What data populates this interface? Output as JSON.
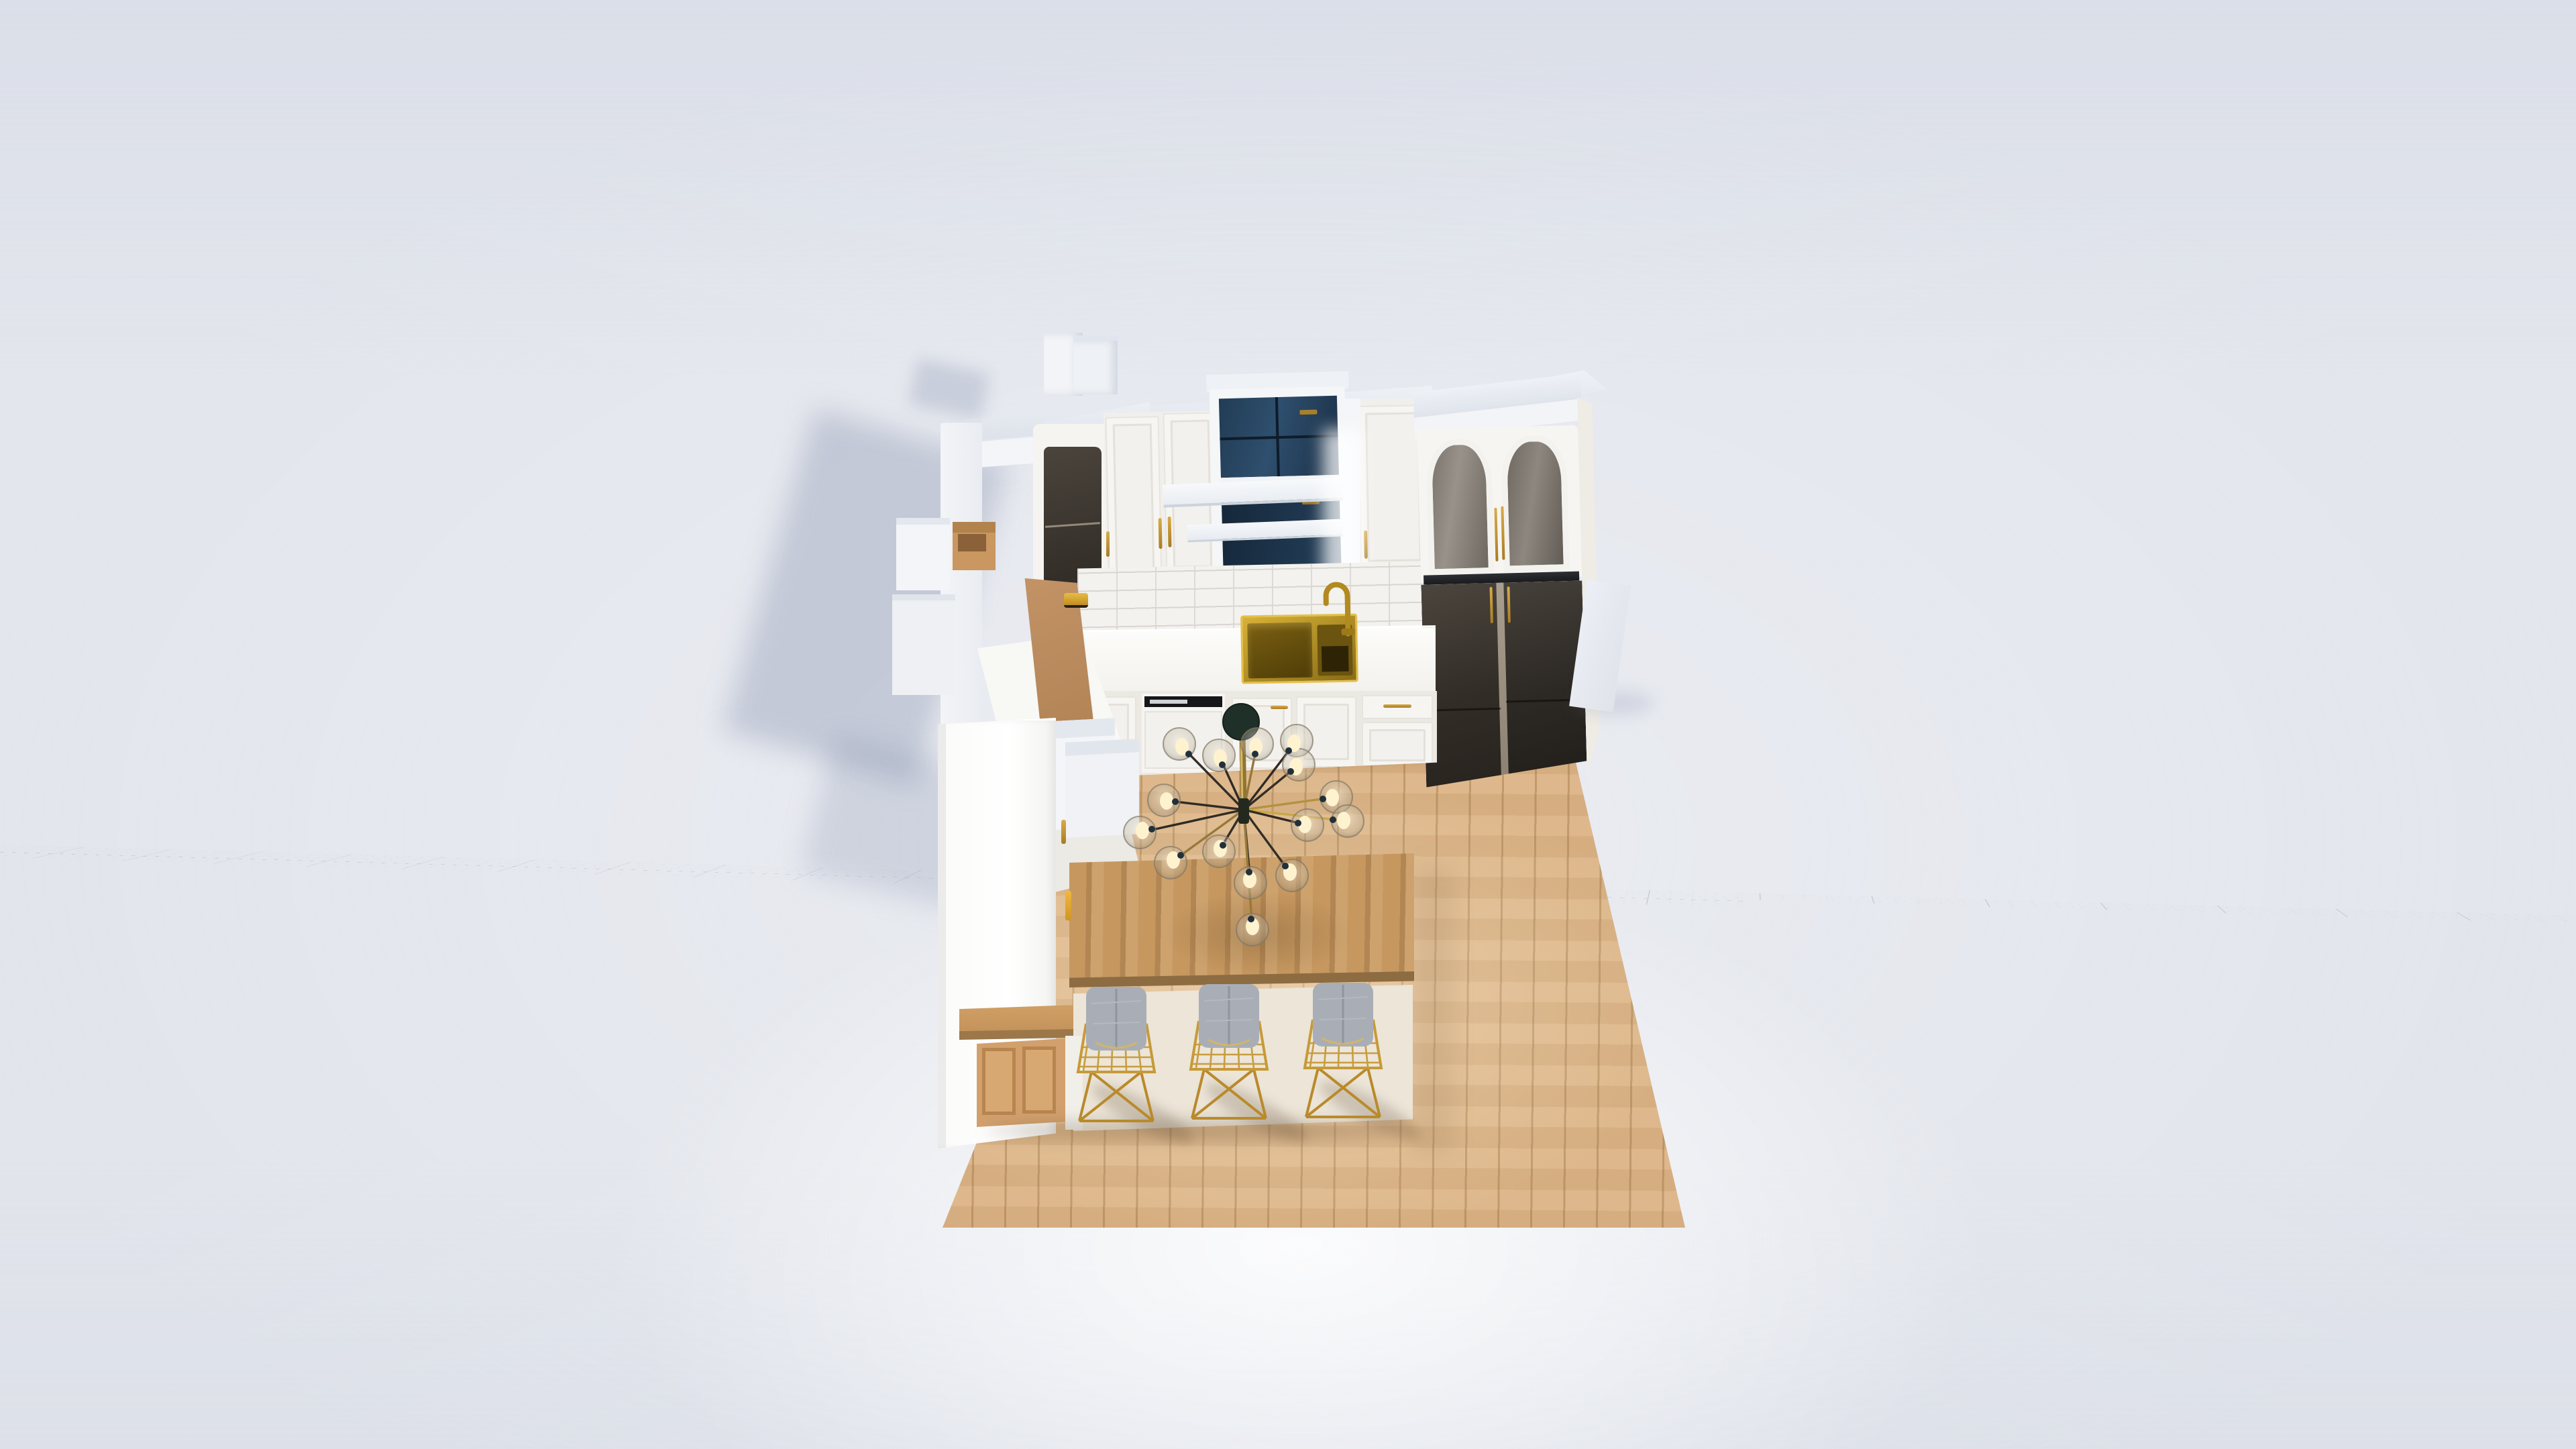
{
  "viewport": {
    "type": "3d-floorplanner-canvas",
    "description": "Top-down 3D render of a kitchen model placed on an empty perspective grid canvas; no menus, toolbars or text are visible",
    "grid": {
      "base_color": "#e2e5ec",
      "minor_line_color": "#d4d9e3",
      "major_line_color": "#a9b2c5",
      "glow_color": "#ffffff"
    },
    "palette": {
      "cabinet_white": "#f5f4f1",
      "wall_cap_gray": "#dfe4ec",
      "counter_white": "#fbfbf8",
      "brass": "#c09434",
      "sink_brass": "#8f7118",
      "window_glass_dark": "#24405c",
      "hutch_glass_gray": "#827c73",
      "fridge_dark": "#332e27",
      "floor_oak": "#dcb486",
      "island_oak": "#c6975f",
      "island_base_tan": "#d2a06d",
      "board_tan": "#bd8f62",
      "stool_cushion_gray": "#a9aeb6",
      "tile_grout": "#d9d6d1",
      "shadow_blue": "#707fa0"
    },
    "objects": {
      "grid": {
        "label": "perspective grid canvas"
      },
      "kitchen": {
        "label": "kitchen 3D model"
      },
      "chimney_boxes": {
        "label": "white boxes standing behind the back wall",
        "count": 2
      },
      "back_wall": {
        "label": "white back wall with gray top cap"
      },
      "corner_cabinet": {
        "label": "corner wall cabinet with smoked glass door"
      },
      "wall_cabinets_left": {
        "label": "white shaker wall cabinets",
        "door_count": 2
      },
      "window": {
        "label": "double-hung window with dark glazing"
      },
      "floating_shelves": {
        "label": "white floating shelves in front of window",
        "count": 2
      },
      "wall_cabinet_right": {
        "label": "white shaker wall cabinet",
        "door_count": 1
      },
      "hutch": {
        "label": "tall unit with arched glass doors",
        "door_count": 2
      },
      "refrigerator": {
        "label": "dark double-door refrigerator below hutch"
      },
      "backsplash": {
        "label": "white subway-tile backsplash"
      },
      "countertop": {
        "label": "white countertop run"
      },
      "sink": {
        "label": "brass double-bowl sink with gooseneck faucet"
      },
      "dishwasher": {
        "label": "panel-front dishwasher with black control strip"
      },
      "base_cabinets": {
        "label": "white shaker base cabinets"
      },
      "left_counter": {
        "label": "left counter return with small glass cabinet"
      },
      "wood_board": {
        "label": "tan board leaning on left counter"
      },
      "crate": {
        "label": "small tan open crate outside wall"
      },
      "gold_item": {
        "label": "small gold object on counter"
      },
      "partition_wall": {
        "label": "tall white partition wall at front left"
      },
      "island": {
        "label": "island / dining table with oak top and tan shaker panels"
      },
      "bar_stools": {
        "label": "gold wire bar stools with gray cushions",
        "count": 3
      },
      "chandelier": {
        "label": "brass sputnik chandelier with glass globes",
        "bulb_count": 15
      },
      "loose_plank": {
        "label": "loose white panel lying on the canvas"
      },
      "wood_floor": {
        "label": "light oak plank floor area"
      }
    }
  }
}
